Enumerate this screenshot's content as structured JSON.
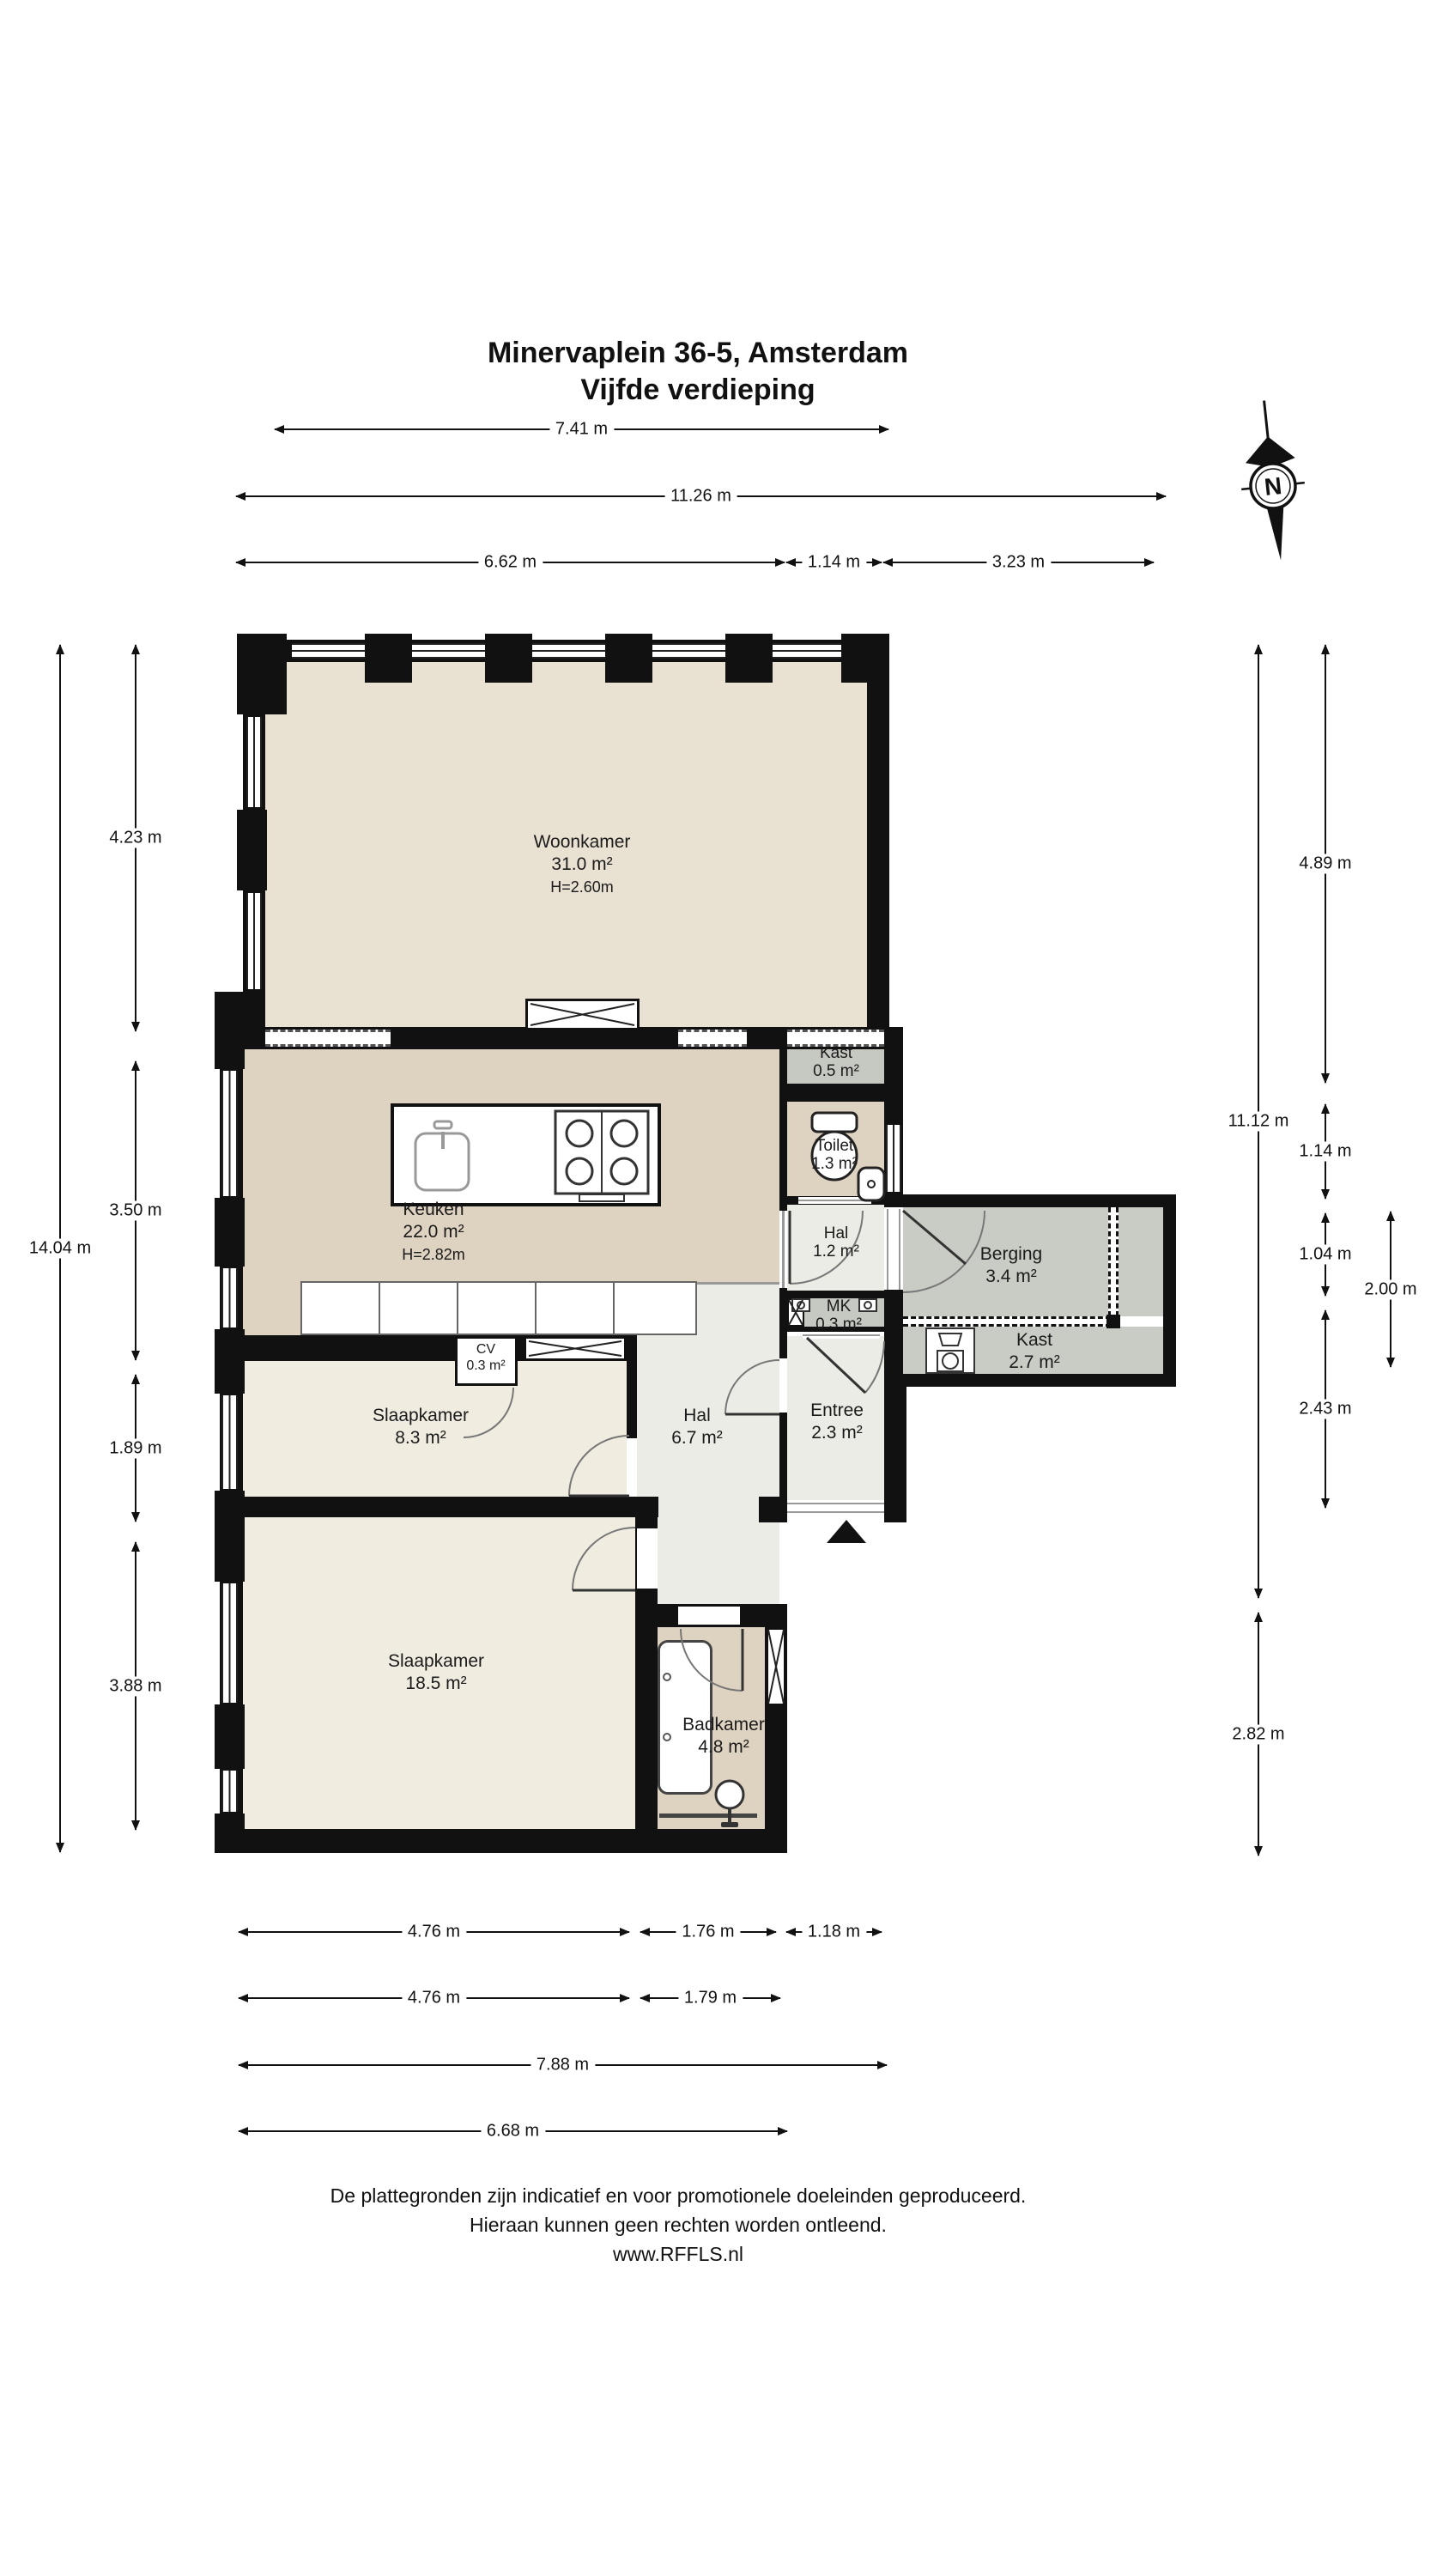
{
  "title": {
    "line1": "Minervaplein 36-5, Amsterdam",
    "line2": "Vijfde verdieping"
  },
  "compass": {
    "label": "N"
  },
  "rooms": {
    "woonkamer": {
      "name": "Woonkamer",
      "area": "31.0 m²",
      "height": "H=2.60m"
    },
    "keuken": {
      "name": "Keuken",
      "area": "22.0 m²",
      "height": "H=2.82m"
    },
    "kast_boven": {
      "name": "Kast",
      "area": "0.5 m²"
    },
    "toilet": {
      "name": "Toilet",
      "area": "1.3 m²"
    },
    "hal_klein": {
      "name": "Hal",
      "area": "1.2 m²"
    },
    "mk": {
      "name": "MK",
      "area": "0.3 m²"
    },
    "entree": {
      "name": "Entree",
      "area": "2.3 m²"
    },
    "berging": {
      "name": "Berging",
      "area": "3.4 m²"
    },
    "kast_berging": {
      "name": "Kast",
      "area": "2.7 m²"
    },
    "hal": {
      "name": "Hal",
      "area": "6.7 m²"
    },
    "slaapkamer_klein": {
      "name": "Slaapkamer",
      "area": "8.3 m²"
    },
    "slaapkamer_groot": {
      "name": "Slaapkamer",
      "area": "18.5 m²"
    },
    "badkamer": {
      "name": "Badkamer",
      "area": "4.8 m²"
    },
    "cv": {
      "name": "CV",
      "area": "0.3 m²"
    }
  },
  "dimensions": {
    "top": [
      "7.41 m",
      "11.26 m",
      "6.62 m",
      "1.14 m",
      "3.23 m"
    ],
    "bottom": [
      "4.76 m",
      "1.76 m",
      "1.18 m",
      "4.76 m",
      "1.79 m",
      "7.88 m",
      "6.68 m"
    ],
    "left": [
      "14.04 m",
      "4.23 m",
      "3.50 m",
      "1.89 m",
      "3.88 m"
    ],
    "right": [
      "11.12 m",
      "2.82 m",
      "4.89 m",
      "1.14 m",
      "1.04 m",
      "2.43 m",
      "2.00 m"
    ]
  },
  "footer": {
    "line1": "De plattegronden zijn indicatief en voor promotionele doeleinden geproduceerd.",
    "line2": "Hieraan kunnen geen rechten worden ontleend.",
    "line3": "www.RFFLS.nl"
  },
  "colors": {
    "wall": "#111111",
    "woonkamer_floor": "#e9e1d2",
    "keuken_floor": "#ded3c0",
    "slaapkamer_floor": "#f0ece0",
    "hal_floor": "#ececE6",
    "berging_floor": "#c9ccc4",
    "kast_floor": "#c6c8c2"
  }
}
